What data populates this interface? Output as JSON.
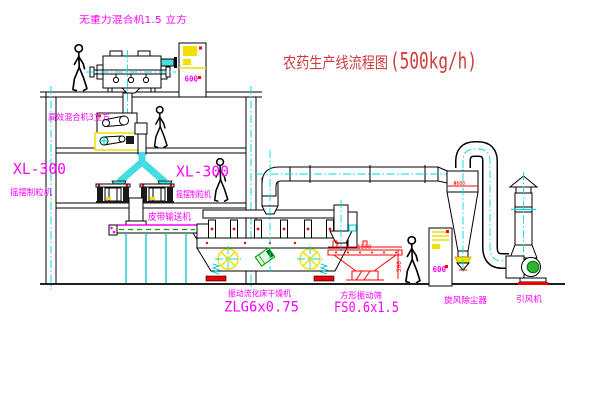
{
  "page": {
    "background": "#ffffff"
  },
  "title": {
    "name": "农药生产线流程图",
    "capacity": "(500kg/h)"
  },
  "equipment": {
    "gravity_free_mixer": {
      "label": "无重力混合机1.5 立方"
    },
    "high_efficiency_mixer": {
      "label": "高效混合机3立方"
    },
    "granulator_left": {
      "model": "XL-300",
      "name": "摇摆制粒机"
    },
    "granulator_right": {
      "model": "XL-300",
      "name": "摇摆制粒机"
    },
    "belt_conveyor": {
      "label": "皮带输送机"
    },
    "fluid_bed_dryer": {
      "name": "振动流化床干燥机",
      "model": "ZLG6x0.75"
    },
    "vibrating_screen": {
      "name": "方形振动筛",
      "model": "FS0.6x1.5"
    },
    "cyclone_dust_collector": {
      "label": "旋风除尘器",
      "dim_label": "Φ600"
    },
    "induced_draft_fan": {
      "label": "引风机"
    },
    "control_cabinet_top": {
      "label": "600"
    },
    "control_cabinet_right": {
      "label": "600"
    }
  },
  "dimensions": {
    "screen_length": "1500",
    "screen_height": "500"
  },
  "colors": {
    "label_magenta": "#ff00ff",
    "title_red": "#cf3a3a",
    "centerline_cyan": "#00dcdc",
    "cabinet_yellow": "#f0e000",
    "accent_red": "#ff0000",
    "motor_green": "#00a000",
    "line_black": "#000000"
  }
}
